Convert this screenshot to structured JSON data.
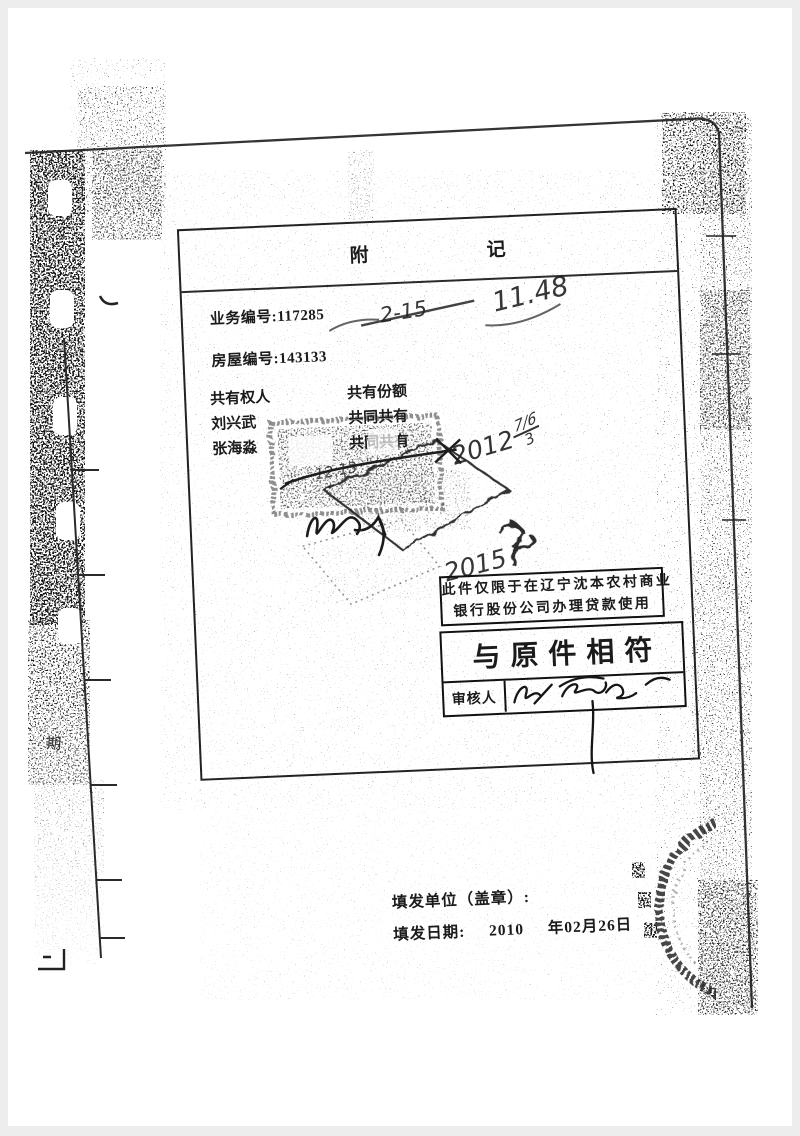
{
  "colors": {
    "frame": "#ededed",
    "paper": "#ffffff",
    "ink": "#1b1b1b"
  },
  "remark": {
    "title_1": "附",
    "title_2": "记",
    "business_no": "业务编号:117285",
    "house_no": "房屋编号:143133",
    "owners": {
      "header": [
        "共有权人",
        "共有份额"
      ],
      "rows": [
        {
          "name": "刘兴武",
          "share": "共同共有"
        },
        {
          "name": "张海淼",
          "share": "共同共有"
        }
      ]
    }
  },
  "bank_box": {
    "line1": "此件仅限于在辽宁沈本农村商业",
    "line2": "银行股份公司办理贷款使用"
  },
  "verify_box": {
    "title": "与原件相符",
    "reviewer_label": "审核人"
  },
  "footer": {
    "issuer": "填发单位（盖章）:",
    "date_prefix": "填发日期:",
    "date_year": "2010",
    "date_rest": "年02月26日"
  },
  "handwriting": {
    "crossed_note": "2-15",
    "time_note": "11.48",
    "date_main": "2012",
    "date_up": "7/6",
    "date_down": "3",
    "year_note": "2015",
    "stamp_note": "12.13"
  },
  "margin": {
    "binding_glyph": "期"
  }
}
